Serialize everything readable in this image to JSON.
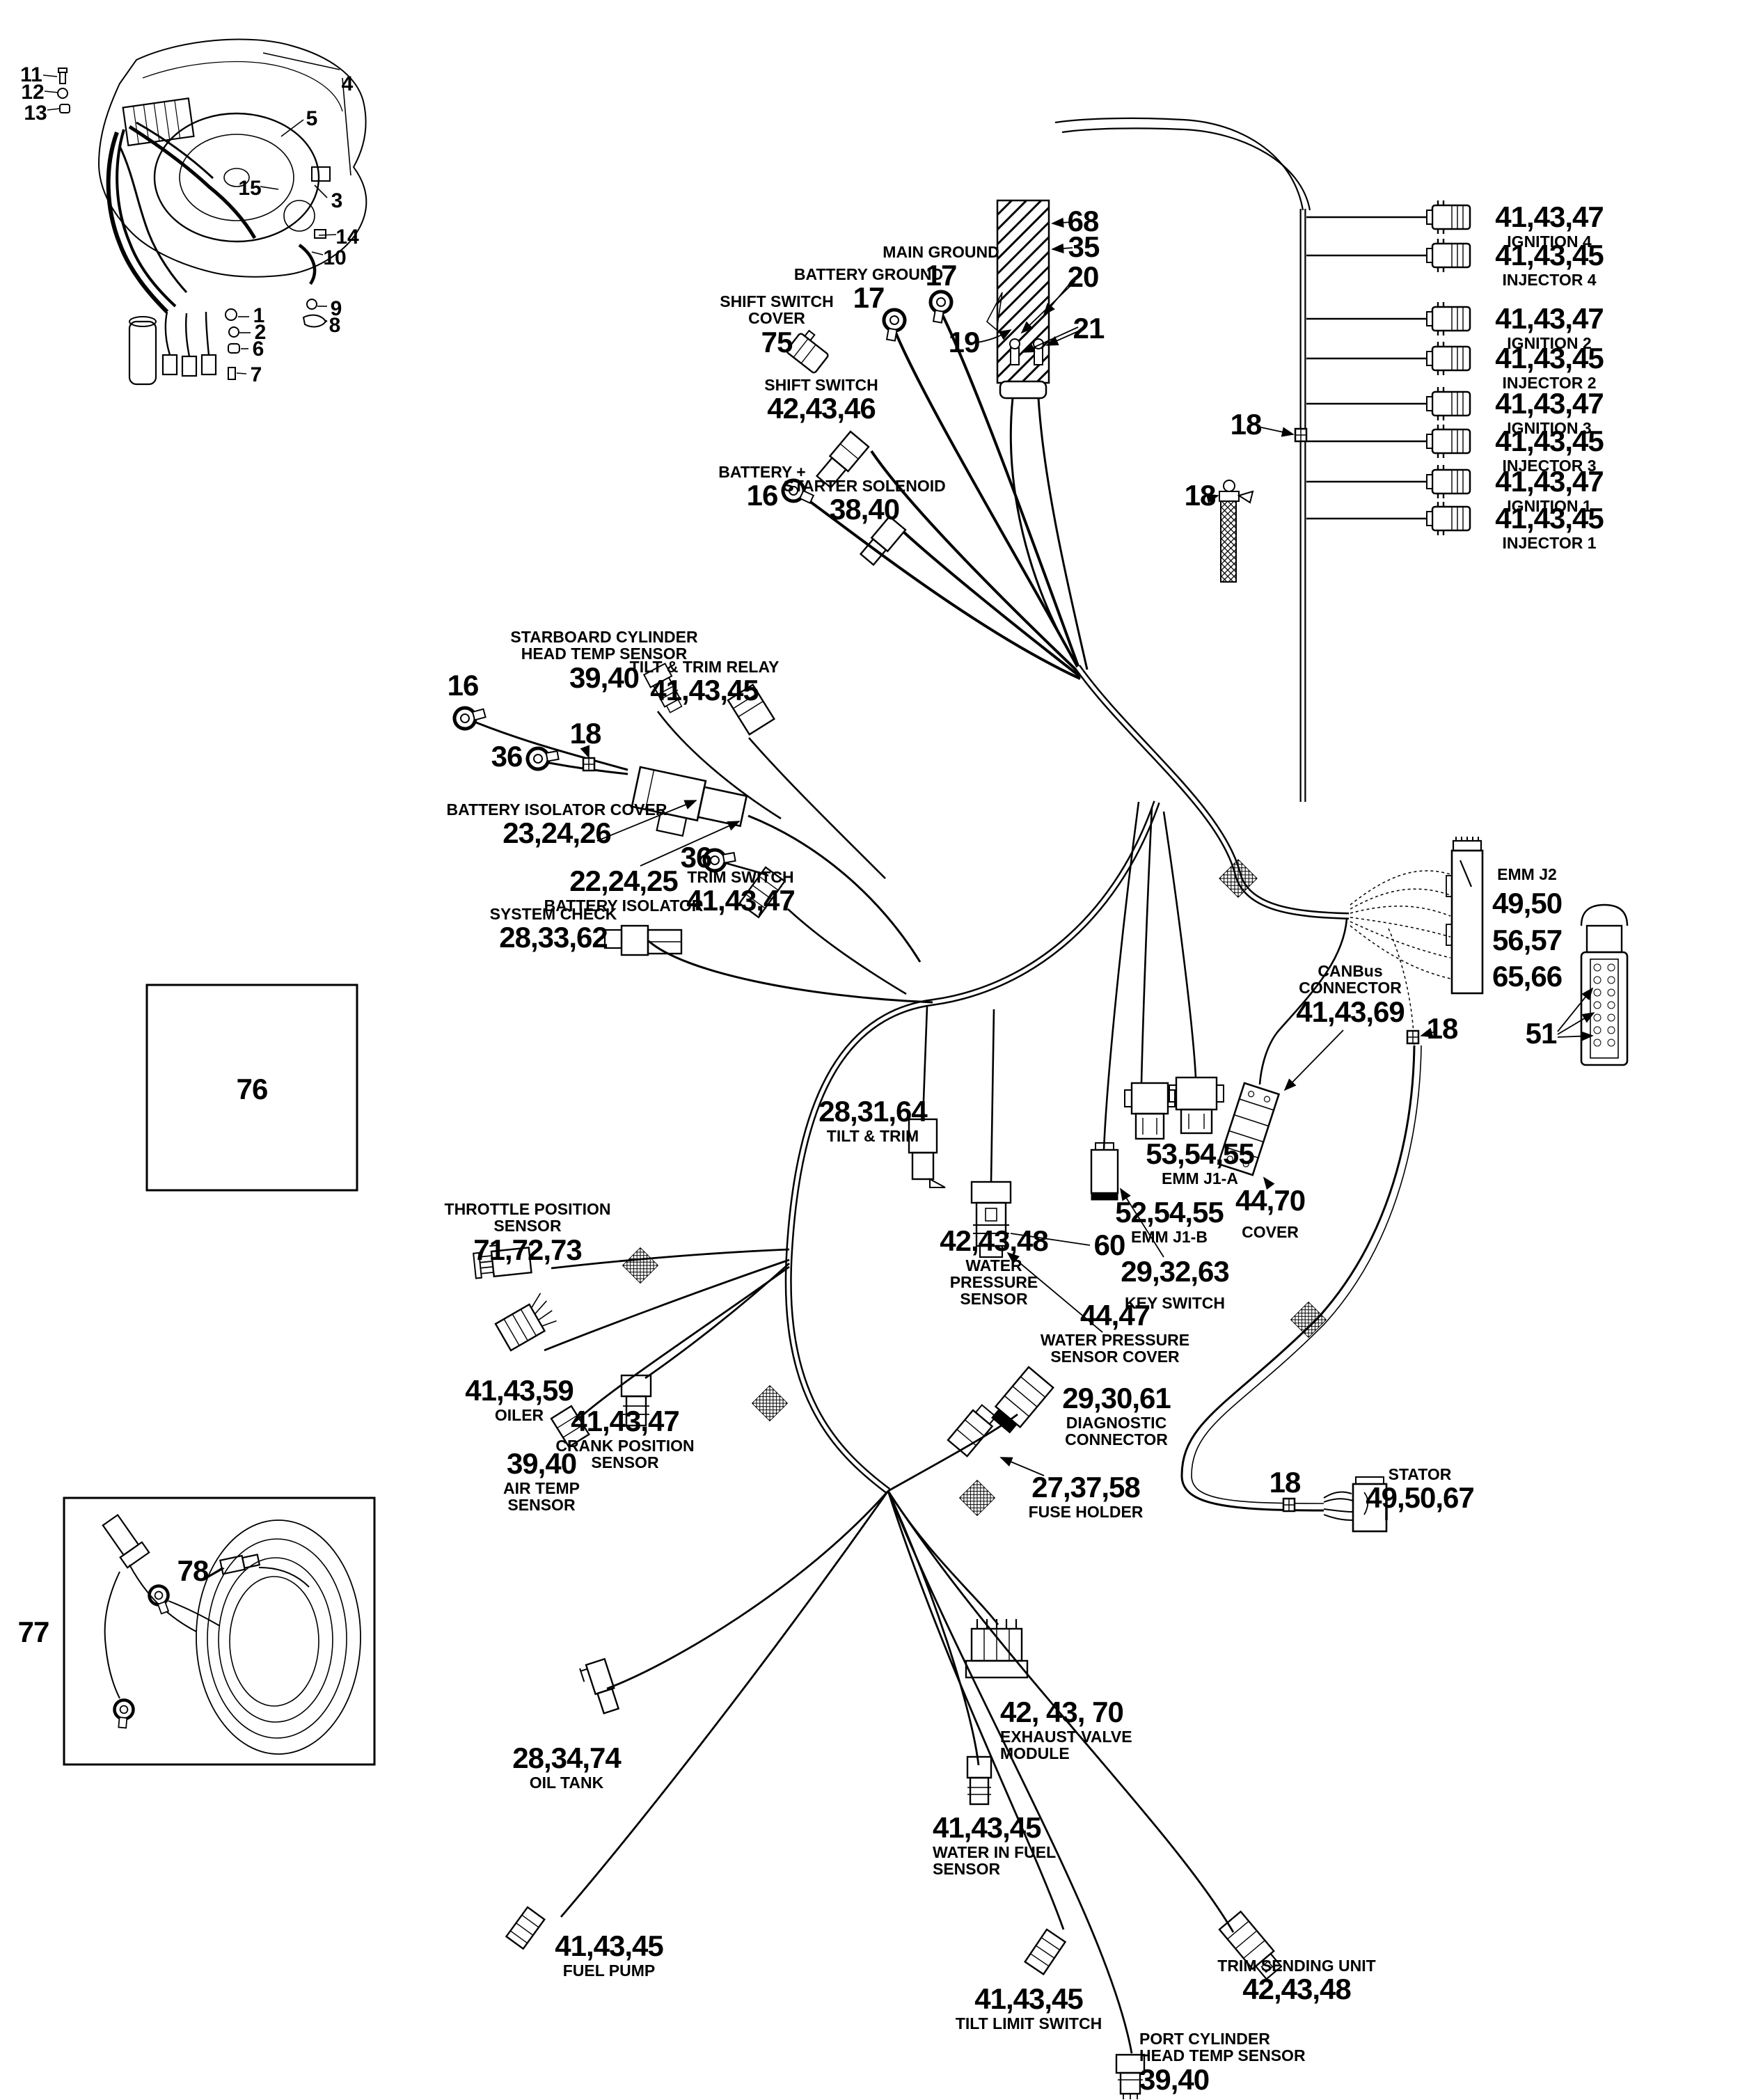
{
  "page": {
    "background": "#ffffff",
    "ink": "#000000",
    "type": "electrical harness parts diagram"
  },
  "icons": {
    "engine": "engine-assembly-icon",
    "battery_cable": "battery-cable-wrap-icon",
    "ring": "ring-terminal-icon",
    "connector": "connector-plug-icon",
    "clip": "cable-clip-icon",
    "wrap": "loom-wrap-icon",
    "coil": "harness-coil-icon"
  },
  "callouts": {
    "engine": {
      "n1": "1",
      "n2": "2",
      "n3": "3",
      "n4": "4",
      "n5": "5",
      "n6": "6",
      "n7": "7",
      "n8": "8",
      "n9": "9",
      "n10": "10",
      "n11": "11",
      "n12": "12",
      "n13": "13",
      "n14": "14",
      "n15": "15"
    },
    "shift_switch_cover": {
      "label": [
        "SHIFT SWITCH",
        "COVER"
      ],
      "num": "75"
    },
    "shift_switch": {
      "label": [
        "SHIFT SWITCH"
      ],
      "num": "42,43,46"
    },
    "battery_ground": {
      "label": [
        "BATTERY GROUND"
      ],
      "num": "17"
    },
    "main_ground": {
      "label": [
        "MAIN GROUND"
      ],
      "num": "17"
    },
    "battery_plus": {
      "label": [
        "BATTERY +"
      ],
      "num": "16"
    },
    "starter_solenoid": {
      "label": [
        "STARTER SOLENOID"
      ],
      "num": "38,40"
    },
    "n68": {
      "num": "68"
    },
    "n35": {
      "num": "35"
    },
    "n20": {
      "num": "20"
    },
    "n21": {
      "num": "21"
    },
    "n19": {
      "num": "19"
    },
    "n18_harness": {
      "num": "18"
    },
    "n18_ground": {
      "num": "18"
    },
    "ignition_4": {
      "num": "41,43,47",
      "label": [
        "IGNITION 4"
      ]
    },
    "injector_4": {
      "num": "41,43,45",
      "label": [
        "INJECTOR 4"
      ]
    },
    "ignition_2": {
      "num": "41,43,47",
      "label": [
        "IGNITION 2"
      ]
    },
    "injector_2": {
      "num": "41,43,45",
      "label": [
        "INJECTOR 2"
      ]
    },
    "ignition_3": {
      "num": "41,43,47",
      "label": [
        "IGNITION 3"
      ]
    },
    "injector_3": {
      "num": "41,43,45",
      "label": [
        "INJECTOR 3"
      ]
    },
    "ignition_1": {
      "num": "41,43,47",
      "label": [
        "IGNITION 1"
      ]
    },
    "injector_1": {
      "num": "41,43,45",
      "label": [
        "INJECTOR 1"
      ]
    },
    "n16_ring": {
      "num": "16"
    },
    "n36_a": {
      "num": "36"
    },
    "n36_b": {
      "num": "36"
    },
    "n18_isolator": {
      "num": "18"
    },
    "starboard_head_temp": {
      "label": [
        "STARBOARD CYLINDER",
        "HEAD TEMP SENSOR"
      ],
      "num": "39,40"
    },
    "tilt_trim_relay": {
      "label": [
        "TILT & TRIM RELAY"
      ],
      "num": "41,43,45"
    },
    "battery_isolator_cover": {
      "label": [
        "BATTERY ISOLATOR COVER"
      ],
      "num": "23,24,26"
    },
    "battery_isolator": {
      "num": "22,24,25",
      "label": [
        "BATTERY ISOLATOR"
      ]
    },
    "trim_switch": {
      "label": [
        "TRIM SWITCH"
      ],
      "num": "41,43,47"
    },
    "system_check": {
      "label": [
        "SYSTEM CHECK"
      ],
      "num": "28,33,62"
    },
    "emm_j2": {
      "label": [
        "EMM J2"
      ],
      "nums": [
        "49,50",
        "56,57",
        "65,66"
      ]
    },
    "n51": {
      "num": "51"
    },
    "canbus": {
      "label": [
        "CANBus",
        "CONNECTOR"
      ],
      "num": "41,43,69"
    },
    "n18_emm": {
      "num": "18"
    },
    "emm_j1a": {
      "num": "53,54,55",
      "label": [
        "EMM J1-A"
      ]
    },
    "emm_j1b": {
      "num": "52,54,55",
      "label": [
        "EMM J1-B"
      ]
    },
    "canbus_cover": {
      "num": "44,70",
      "label": [
        "COVER"
      ]
    },
    "key_switch": {
      "num": "29,32,63",
      "label": [
        "KEY SWITCH"
      ]
    },
    "tilt_trim": {
      "num": "28,31,64",
      "label": [
        "TILT & TRIM"
      ]
    },
    "water_pressure_sensor": {
      "num": "42,43,48",
      "label": [
        "WATER",
        "PRESSURE",
        "SENSOR"
      ]
    },
    "n60": {
      "num": "60"
    },
    "water_pressure_cover": {
      "num": "44,47",
      "label": [
        "WATER PRESSURE",
        "SENSOR COVER"
      ]
    },
    "diagnostic": {
      "num": "29,30,61",
      "label": [
        "DIAGNOSTIC",
        "CONNECTOR"
      ]
    },
    "fuse_holder": {
      "num": "27,37,58",
      "label": [
        "FUSE HOLDER"
      ]
    },
    "n18_stator": {
      "num": "18"
    },
    "stator": {
      "label": [
        "STATOR"
      ],
      "num": "49,50,67"
    },
    "throttle_position": {
      "label": [
        "THROTTLE POSITION",
        "SENSOR"
      ],
      "num": "71,72,73"
    },
    "oiler": {
      "num": "41,43,59",
      "label": [
        "OILER"
      ]
    },
    "crank_position": {
      "num": "41,43,47",
      "label": [
        "CRANK POSITION",
        "SENSOR"
      ]
    },
    "air_temp": {
      "num": "39,40",
      "label": [
        "AIR TEMP",
        "SENSOR"
      ]
    },
    "n76": {
      "num": "76"
    },
    "n77": {
      "num": "77"
    },
    "n78": {
      "num": "78"
    },
    "oil_tank": {
      "num": "28,34,74",
      "label": [
        "OIL TANK"
      ]
    },
    "fuel_pump": {
      "num": "41,43,45",
      "label": [
        "FUEL PUMP"
      ]
    },
    "exhaust_valve_module": {
      "num": "42, 43, 70",
      "label": [
        "EXHAUST VALVE",
        "MODULE"
      ]
    },
    "water_in_fuel": {
      "num": "41,43,45",
      "label": [
        "WATER IN FUEL",
        "SENSOR"
      ]
    },
    "tilt_limit_switch": {
      "num": "41,43,45",
      "label": [
        "TILT LIMIT SWITCH"
      ]
    },
    "port_head_temp": {
      "label": [
        "PORT CYLINDER",
        "HEAD TEMP SENSOR"
      ],
      "num": "39,40"
    },
    "trim_sending_unit": {
      "label": [
        "TRIM SENDING UNIT"
      ],
      "num": "42,43,48"
    }
  }
}
